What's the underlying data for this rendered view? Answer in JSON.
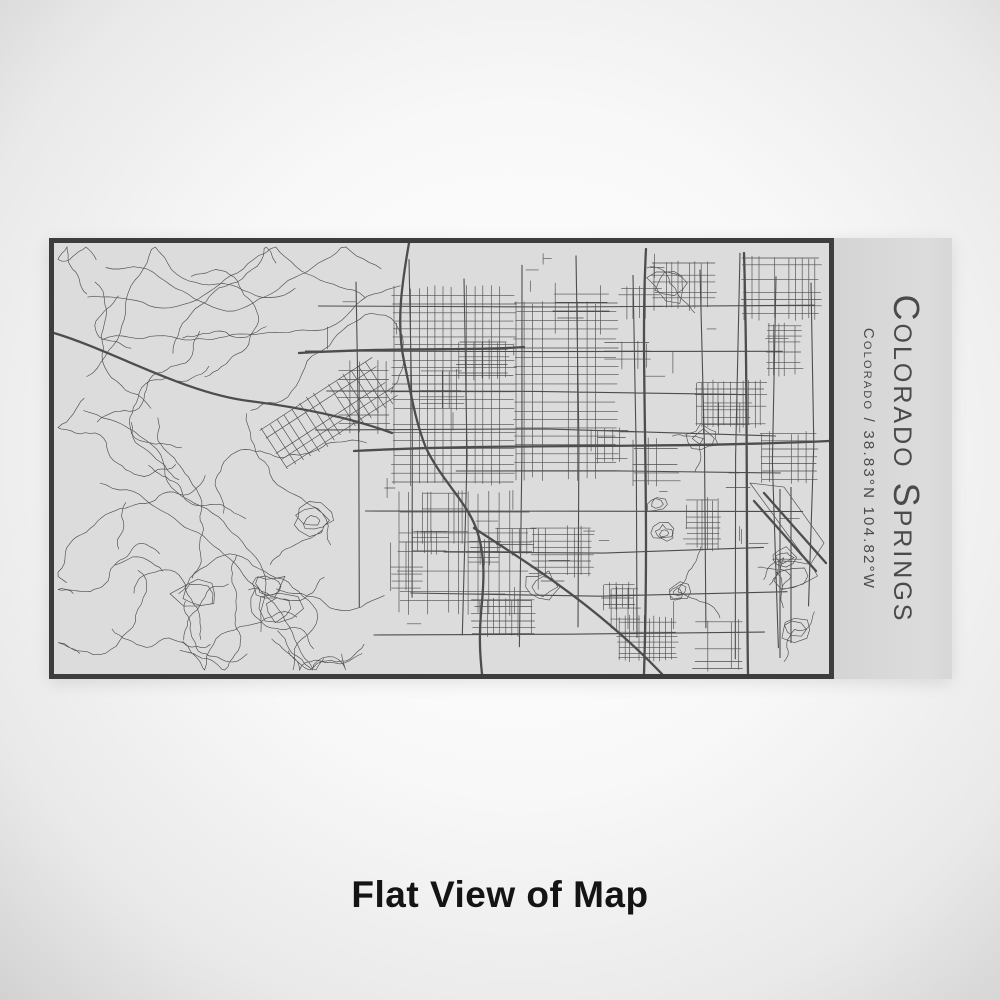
{
  "engraving": {
    "title": "Colorado Springs",
    "subtitle": "Colorado / 38.83°N 104.82°W"
  },
  "caption": {
    "text": "Flat View of Map"
  },
  "colors": {
    "map_background": "#dcdcdc",
    "map_lines": "#4d4d4d",
    "frame_border": "#3d3d3d",
    "panel_background": "#d9d9d9",
    "label_text": "#4a4a4a",
    "caption_text": "#141414"
  }
}
